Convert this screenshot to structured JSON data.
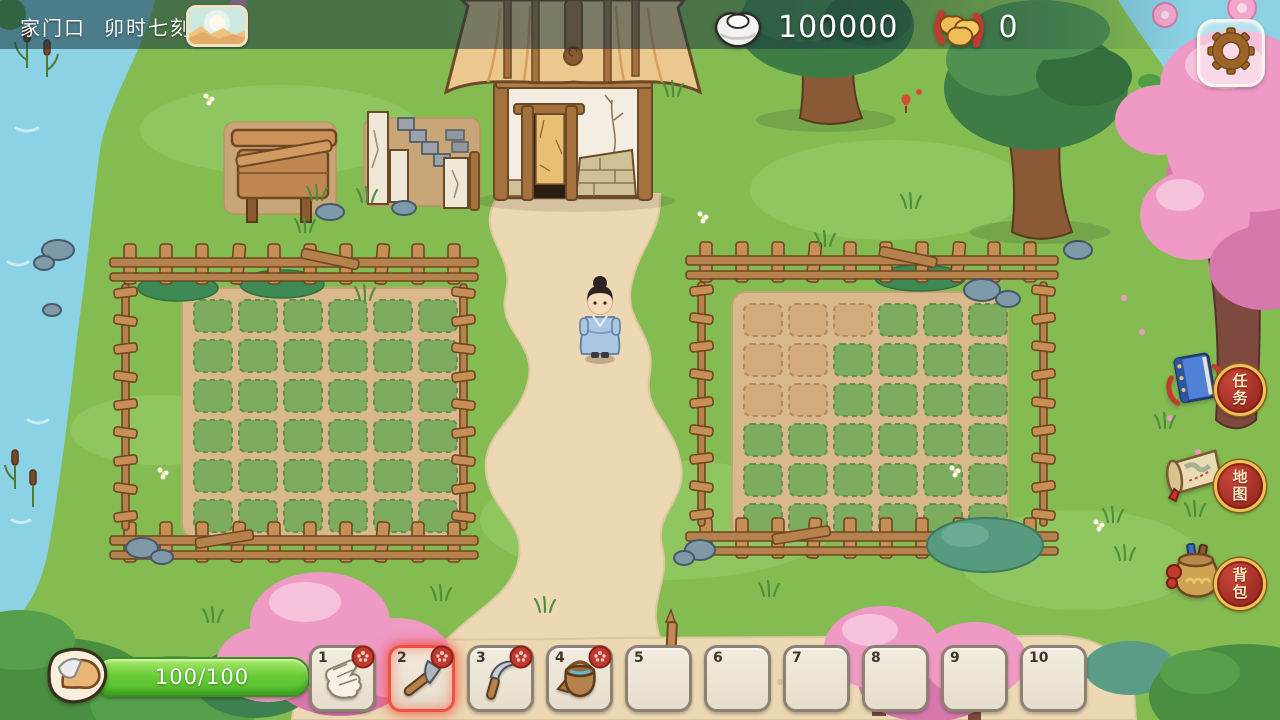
{
  "hud": {
    "topbar": {
      "location": "家门口",
      "time": "卯时七刻",
      "weather_icon": "sunrise-weather-icon"
    },
    "currencies": [
      {
        "id": "silver",
        "icon": "silver-ingot-icon",
        "value": "100000"
      },
      {
        "id": "gold",
        "icon": "gold-ingot-icon",
        "value": "0"
      }
    ],
    "settings_icon": "gear-icon",
    "right_menu": [
      {
        "id": "tasks",
        "label": "任务",
        "icon": "task-book-icon"
      },
      {
        "id": "map",
        "label": "地图",
        "icon": "map-scroll-icon"
      },
      {
        "id": "bag",
        "label": "背包",
        "icon": "bag-pouch-icon"
      }
    ],
    "stamina": {
      "icon": "arm-strength-icon",
      "value": "100/100"
    },
    "hotbar": {
      "selected": 2,
      "slots": [
        {
          "num": "1",
          "icon": "glove-icon",
          "locked": true
        },
        {
          "num": "2",
          "icon": "hoe-icon",
          "locked": true
        },
        {
          "num": "3",
          "icon": "sickle-icon",
          "locked": true
        },
        {
          "num": "4",
          "icon": "bucket-icon",
          "locked": true
        },
        {
          "num": "5"
        },
        {
          "num": "6"
        },
        {
          "num": "7"
        },
        {
          "num": "8"
        },
        {
          "num": "9"
        },
        {
          "num": "10"
        }
      ]
    }
  },
  "scene": {
    "fields": [
      {
        "id": "left",
        "rows": 6,
        "cols": 6,
        "tilled": []
      },
      {
        "id": "right",
        "rows": 6,
        "cols": 6,
        "tilled": [
          [
            0,
            0
          ],
          [
            0,
            1
          ],
          [
            0,
            2
          ],
          [
            1,
            0
          ],
          [
            1,
            1
          ],
          [
            2,
            0
          ],
          [
            2,
            1
          ]
        ]
      }
    ],
    "character": "player-character"
  },
  "colors": {
    "accent_red": "#ef5040",
    "stamina_green": "#5ec535",
    "badge_red": "#b8392c",
    "badge_gold": "#eec25a",
    "grass": "#84bc52",
    "water": "#8ad2e4",
    "path": "#ecd9b4"
  }
}
